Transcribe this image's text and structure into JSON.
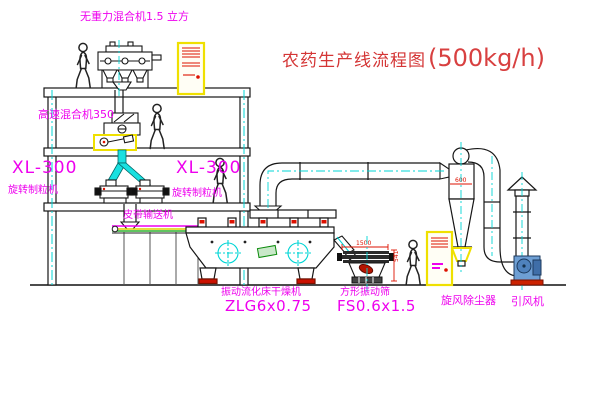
{
  "diagram": {
    "title": "农药生产线流程图",
    "capacity": "(500kg/h)"
  },
  "labels": {
    "gravity_mixer": "无重力混合机1.5 立方",
    "high_speed_mixer": "高速混合机350",
    "granulator_left": {
      "model": "XL-300",
      "name": "旋转制粒机"
    },
    "granulator_right": {
      "model": "XL-300",
      "name": "旋转制粒机"
    },
    "belt_conveyor": "皮带输送机",
    "fluid_bed_dryer": {
      "name": "振动流化床干燥机",
      "model": "ZLG6x0.75"
    },
    "vibrating_sieve": {
      "name": "方形振动筛",
      "model": "FS0.6x1.5"
    },
    "cyclone": "旋风除尘器",
    "induced_draft_fan": "引风机"
  },
  "dimensions": {
    "cyclone_outlet": "600",
    "sieve_length": "1500",
    "sieve_height": "541"
  },
  "colors": {
    "line": "#1a1a1a",
    "centerline": "#00d5d5",
    "label_magenta": "#ee00ee",
    "title_red": "#d43535",
    "cabinet_yellow": "#efe000",
    "detail_red": "#dd1100"
  }
}
